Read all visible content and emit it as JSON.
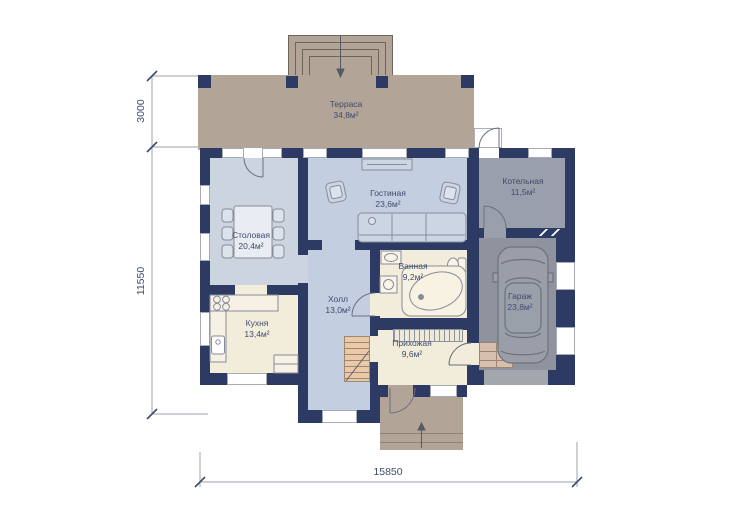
{
  "plan_type": "house-floor-plan",
  "rooms": [
    {
      "id": "terrace",
      "name": "Терраса",
      "area": "34,8м²"
    },
    {
      "id": "dining",
      "name": "Столовая",
      "area": "20,4м²"
    },
    {
      "id": "living",
      "name": "Гостиная",
      "area": "23,6м²"
    },
    {
      "id": "boiler",
      "name": "Котельная",
      "area": "11,5м²"
    },
    {
      "id": "bath",
      "name": "Ванная",
      "area": "9,2м²"
    },
    {
      "id": "garage",
      "name": "Гараж",
      "area": "23,8м²"
    },
    {
      "id": "kitchen",
      "name": "Кухня",
      "area": "13,4м²"
    },
    {
      "id": "hall",
      "name": "Холл",
      "area": "13,0м²"
    },
    {
      "id": "entry",
      "name": "Прихожая",
      "area": "9,6м²"
    }
  ],
  "dimensions": {
    "terrace_depth": "3000",
    "house_depth": "11550",
    "house_width": "15850"
  },
  "furniture": [
    "dining-table",
    "chairs",
    "sofa",
    "armchairs",
    "tv-stand",
    "kitchen-counter",
    "stove",
    "kitchen-sink",
    "bath-sink",
    "washer",
    "toilet",
    "corner-bathtub",
    "wardrobe",
    "staircase",
    "car",
    "entry-steps",
    "porch-steps",
    "terrace-steps"
  ],
  "colors": {
    "wall": "#2c3a64",
    "terrace": "#b2a496",
    "floor_blue": "#c3cee1",
    "floor_blue2": "#ccd4df",
    "floor_cream": "#f2ecdb",
    "floor_gray": "#9aa0ab",
    "floor_garage": "#8e939d",
    "apron": "#a2a6ad",
    "stairs": "#e9c9a8",
    "label": "#3f4b6e",
    "dim": "#9ba3ad",
    "outline": "#6d645a",
    "furniture": "#868c99"
  }
}
